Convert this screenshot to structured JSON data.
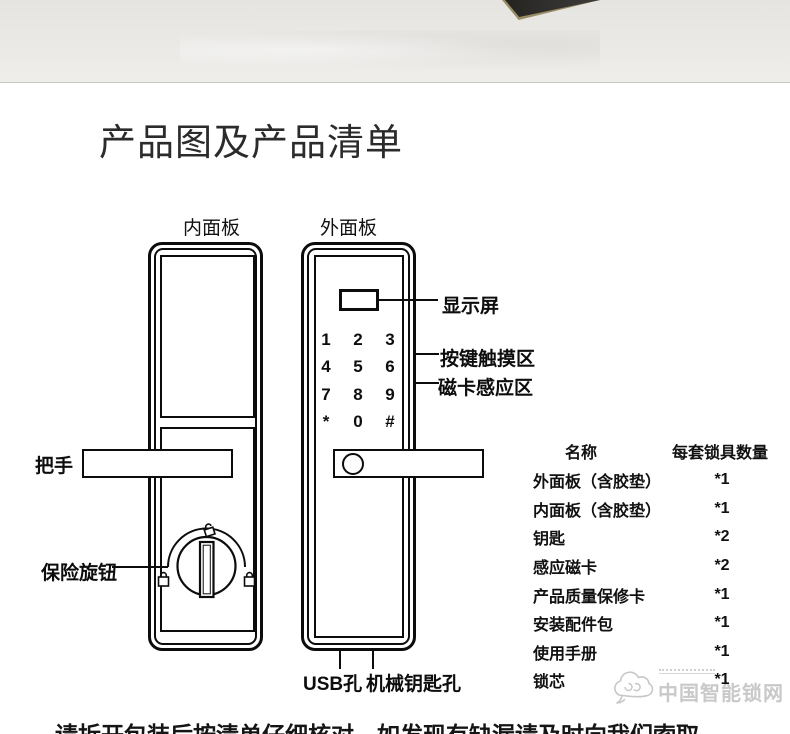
{
  "page": {
    "title": "产品图及产品清单",
    "footer_note": "请拆开包装后按清单仔细核对，如发现有缺漏请及时向我们索取。"
  },
  "diagram": {
    "inner_panel": {
      "label": "内面板",
      "handle_label": "把手",
      "knob_label": "保险旋钮"
    },
    "outer_panel": {
      "label": "外面板",
      "screen_label": "显示屏",
      "keypad_label": "按键触摸区",
      "card_label": "磁卡感应区",
      "usb_label": "USB孔",
      "keyhole_label": "机械钥匙孔",
      "keypad_keys": [
        "1",
        "2",
        "3",
        "4",
        "5",
        "6",
        "7",
        "8",
        "9",
        "*",
        "0",
        "#"
      ]
    }
  },
  "parts_table": {
    "header_name": "名称",
    "header_qty": "每套锁具数量",
    "rows": [
      {
        "name": "外面板（含胶垫）",
        "qty": "*1"
      },
      {
        "name": "内面板（含胶垫）",
        "qty": "*1"
      },
      {
        "name": "钥匙",
        "qty": "*2"
      },
      {
        "name": "感应磁卡",
        "qty": "*2"
      },
      {
        "name": "产品质量保修卡",
        "qty": "*1"
      },
      {
        "name": "安装配件包",
        "qty": "*1"
      },
      {
        "name": "使用手册",
        "qty": "*1"
      },
      {
        "name": "锁芯",
        "qty": "*1"
      }
    ]
  },
  "watermark": {
    "site_name": "中国智能锁网"
  },
  "colors": {
    "line": "#0c0c0c",
    "photo_bg": "#e9e8e5",
    "watermark_gray": "#c9c9c9",
    "box_dark": "#2e2c29"
  }
}
